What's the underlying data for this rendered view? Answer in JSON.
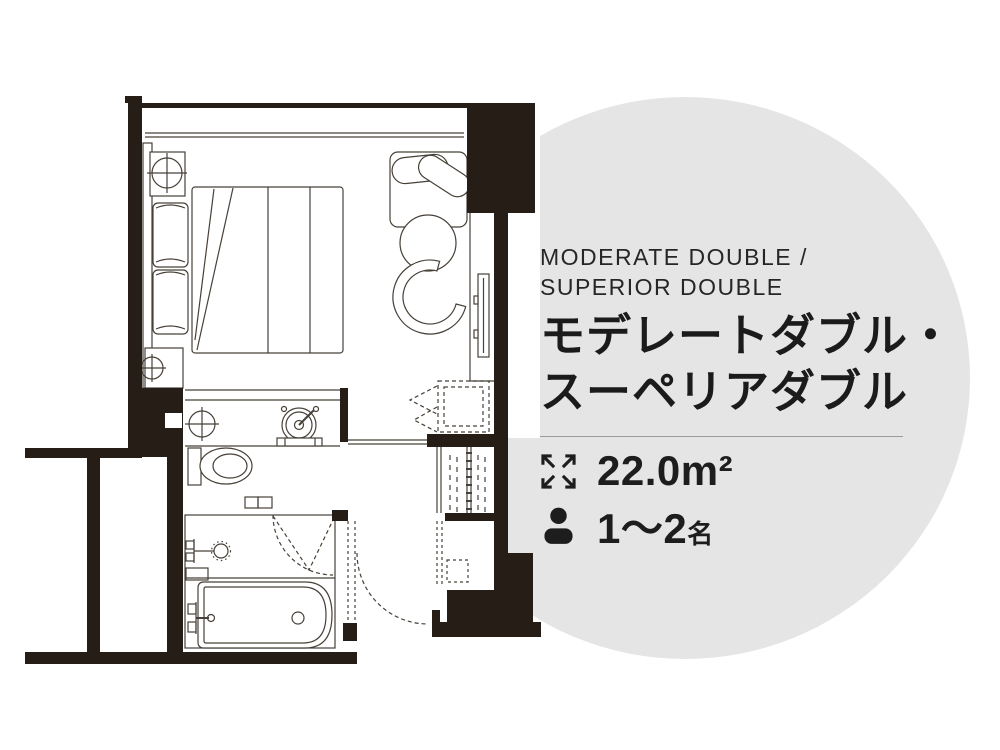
{
  "room_card": {
    "heading_en": {
      "line1": "MODERATE DOUBLE /",
      "line2": "SUPERIOR DOUBLE"
    },
    "title_ja": {
      "line1": "モデレートダブル・",
      "line2": "スーペリアダブル"
    },
    "specs": {
      "area": {
        "icon": "expand-arrows-icon",
        "value": "22.0m²"
      },
      "capacity": {
        "icon": "person-icon",
        "range": "1〜2",
        "unit": "名"
      }
    }
  },
  "colors": {
    "circle_bg": "#e5e5e5",
    "ink": "#1d1d1d",
    "wall": "#251d16",
    "line": "#474038",
    "divider": "#9a9a9a"
  }
}
